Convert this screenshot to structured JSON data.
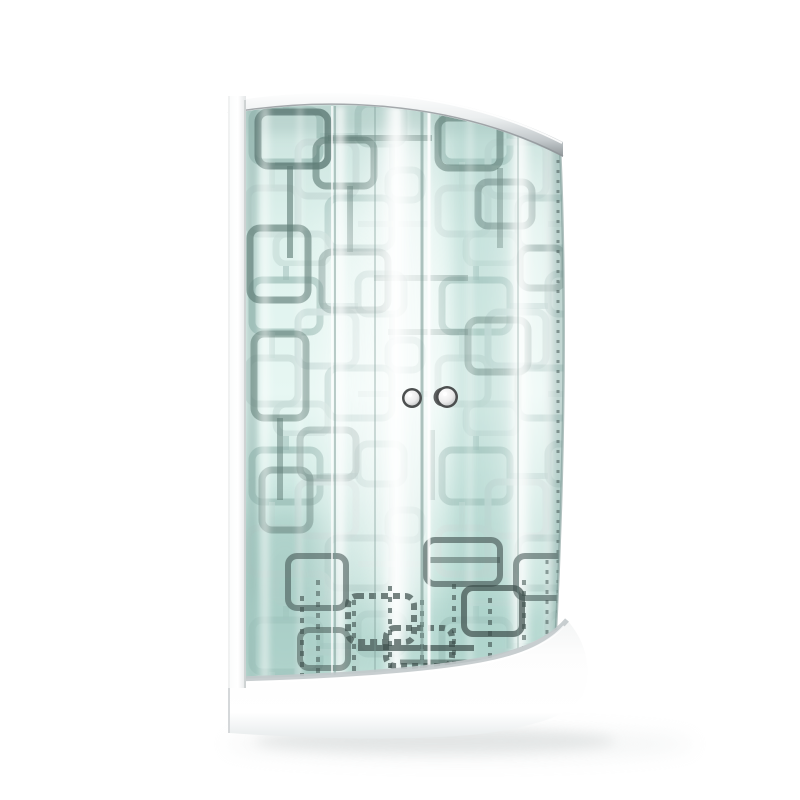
{
  "scene": {
    "description": "Product photograph of a quadrant corner shower enclosure with patterned frosted glass sliding doors, chrome top rail, two round chrome door knobs and a low white curved shower tray on a plain white background",
    "background": "#ffffff",
    "colors": {
      "glass_top": "#c7e0db",
      "glass_hi": "#ddf1ec",
      "glass_bright": "#e7f7f3",
      "glass_mid": "#c4e3dc",
      "glass_deep": "#b9dcd4",
      "glass_low": "#cde7e0",
      "pattern_light": "#c5dad6",
      "pattern_mid": "#8fb2ac",
      "pattern_dark": "#5e7b75",
      "pattern_darkest": "#3d4f4c",
      "seam_dark": "#7d9c96",
      "chrome_top": "#ffffff",
      "chrome_light": "#eceff0",
      "chrome_mid": "#c2c8cb",
      "chrome_dark": "#8e9598",
      "frame_light": "#fafbfb",
      "frame_mid": "#e4e7e8",
      "frame_edge": "#c6cbcc",
      "tray_light": "#fdfdfd",
      "tray_mid": "#f3f5f5",
      "tray_shade": "#e7ebec",
      "tray_rim": "#c2c9cb",
      "shadow": "#dcdfdf",
      "knob_ring": "#4c4f4f",
      "knob_face": "#ececec",
      "knob_face_edge": "#b5b8b9"
    },
    "pattern": {
      "tile": {
        "w": 190,
        "h": 170,
        "squares": [
          {
            "x": 12,
            "y": 14,
            "w": 68,
            "h": 52,
            "k": "mid",
            "o": 0.7
          },
          {
            "x": 58,
            "y": 46,
            "w": 58,
            "h": 54,
            "k": "light",
            "o": 0.9
          },
          {
            "x": 118,
            "y": 8,
            "w": 46,
            "h": 40,
            "k": "mid",
            "o": 0.5
          },
          {
            "x": 8,
            "y": 92,
            "w": 50,
            "h": 46,
            "k": "light",
            "o": 0.8
          },
          {
            "x": 88,
            "y": 102,
            "w": 64,
            "h": 50,
            "k": "mid",
            "o": 0.55
          },
          {
            "x": 36,
            "y": 138,
            "w": 52,
            "h": 30,
            "k": "light",
            "o": 0.7
          },
          {
            "x": 148,
            "y": 74,
            "w": 34,
            "h": 30,
            "k": "mid",
            "o": 0.45
          }
        ],
        "links": [
          {
            "x1": 46,
            "y1": 0,
            "x2": 46,
            "y2": 14,
            "k": "mid",
            "o": 0.5
          },
          {
            "x1": 80,
            "y1": 40,
            "x2": 118,
            "y2": 40,
            "k": "mid",
            "o": 0.45
          },
          {
            "x1": 32,
            "y1": 66,
            "x2": 32,
            "y2": 92,
            "k": "light",
            "o": 0.6
          },
          {
            "x1": 118,
            "y1": 128,
            "x2": 190,
            "y2": 128,
            "k": "light",
            "o": 0.5
          },
          {
            "x1": 152,
            "y1": 48,
            "x2": 152,
            "y2": 74,
            "k": "mid",
            "o": 0.4
          }
        ]
      }
    },
    "motifs_top": [
      {
        "x": 258,
        "y": 112,
        "w": 70,
        "h": 54,
        "o": 0.8
      },
      {
        "x": 316,
        "y": 140,
        "w": 58,
        "h": 46,
        "o": 0.6
      },
      {
        "x": 250,
        "y": 228,
        "w": 58,
        "h": 72,
        "o": 0.65
      },
      {
        "x": 322,
        "y": 252,
        "w": 66,
        "h": 58,
        "o": 0.45
      },
      {
        "x": 254,
        "y": 334,
        "w": 52,
        "h": 84,
        "o": 0.55
      },
      {
        "x": 438,
        "y": 118,
        "w": 62,
        "h": 50,
        "o": 0.6
      },
      {
        "x": 478,
        "y": 182,
        "w": 54,
        "h": 44,
        "o": 0.45
      },
      {
        "x": 520,
        "y": 248,
        "w": 44,
        "h": 40,
        "o": 0.4
      },
      {
        "x": 300,
        "y": 430,
        "w": 56,
        "h": 48,
        "o": 0.4
      },
      {
        "x": 468,
        "y": 320,
        "w": 60,
        "h": 52,
        "o": 0.42
      },
      {
        "x": 262,
        "y": 470,
        "w": 48,
        "h": 60,
        "o": 0.5
      }
    ],
    "links_top": [
      {
        "x1": 290,
        "y1": 166,
        "x2": 290,
        "y2": 258,
        "o": 0.6
      },
      {
        "x1": 328,
        "y1": 138,
        "x2": 432,
        "y2": 138,
        "o": 0.55
      },
      {
        "x1": 350,
        "y1": 186,
        "x2": 350,
        "y2": 252,
        "o": 0.5
      },
      {
        "x1": 374,
        "y1": 278,
        "x2": 468,
        "y2": 278,
        "o": 0.4
      },
      {
        "x1": 280,
        "y1": 418,
        "x2": 280,
        "y2": 500,
        "o": 0.5
      },
      {
        "x1": 500,
        "y1": 168,
        "x2": 500,
        "y2": 248,
        "o": 0.42
      },
      {
        "x1": 388,
        "y1": 332,
        "x2": 468,
        "y2": 332,
        "o": 0.38
      },
      {
        "x1": 432,
        "y1": 430,
        "x2": 432,
        "y2": 500,
        "o": 0.35
      }
    ],
    "motifs_bottom": [
      {
        "x": 288,
        "y": 556,
        "w": 58,
        "h": 52,
        "o": 0.55
      },
      {
        "x": 348,
        "y": 596,
        "w": 66,
        "h": 46,
        "o": 0.7,
        "dash": "7 5"
      },
      {
        "x": 426,
        "y": 540,
        "w": 74,
        "h": 44,
        "o": 0.6
      },
      {
        "x": 464,
        "y": 588,
        "w": 58,
        "h": 46,
        "o": 0.7
      },
      {
        "x": 516,
        "y": 556,
        "w": 50,
        "h": 42,
        "o": 0.55
      },
      {
        "x": 386,
        "y": 628,
        "w": 66,
        "h": 38,
        "o": 0.7,
        "dash": "6 5"
      },
      {
        "x": 300,
        "y": 630,
        "w": 48,
        "h": 38,
        "o": 0.5
      }
    ],
    "dark_strokes": [
      {
        "x1": 302,
        "y1": 596,
        "x2": 302,
        "y2": 676,
        "w": 4,
        "o": 0.6,
        "dash": "5 6"
      },
      {
        "x1": 318,
        "y1": 580,
        "x2": 318,
        "y2": 674,
        "w": 4,
        "o": 0.5,
        "dash": "5 6"
      },
      {
        "x1": 354,
        "y1": 600,
        "x2": 354,
        "y2": 676,
        "w": 4,
        "o": 0.6,
        "dash": "5 6"
      },
      {
        "x1": 390,
        "y1": 586,
        "x2": 390,
        "y2": 672,
        "w": 4,
        "o": 0.65,
        "dash": "5 6"
      },
      {
        "x1": 422,
        "y1": 600,
        "x2": 422,
        "y2": 676,
        "w": 4,
        "o": 0.55,
        "dash": "5 6"
      },
      {
        "x1": 454,
        "y1": 584,
        "x2": 454,
        "y2": 672,
        "w": 4,
        "o": 0.6,
        "dash": "5 6"
      },
      {
        "x1": 490,
        "y1": 598,
        "x2": 490,
        "y2": 670,
        "w": 4,
        "o": 0.6,
        "dash": "5 6"
      },
      {
        "x1": 524,
        "y1": 580,
        "x2": 524,
        "y2": 662,
        "w": 4,
        "o": 0.55,
        "dash": "5 6"
      },
      {
        "x1": 547,
        "y1": 560,
        "x2": 547,
        "y2": 640,
        "w": 3,
        "o": 0.5,
        "dash": "4 6"
      },
      {
        "x1": 358,
        "y1": 648,
        "x2": 474,
        "y2": 648,
        "w": 6,
        "o": 0.7
      },
      {
        "x1": 400,
        "y1": 662,
        "x2": 484,
        "y2": 662,
        "w": 5,
        "o": 0.55
      },
      {
        "x1": 430,
        "y1": 560,
        "x2": 500,
        "y2": 560,
        "w": 6,
        "o": 0.45
      }
    ],
    "streaks": [
      {
        "x": 265,
        "w": 14,
        "o": 0.6
      },
      {
        "x": 300,
        "w": 8,
        "o": 0.45
      },
      {
        "x": 340,
        "w": 16,
        "o": 0.85
      },
      {
        "x": 396,
        "w": 30,
        "o": 0.95
      },
      {
        "x": 428,
        "w": 6,
        "o": 0.5
      },
      {
        "x": 470,
        "w": 10,
        "o": 0.4
      },
      {
        "x": 520,
        "w": 26,
        "o": 0.9
      },
      {
        "x": 549,
        "w": 10,
        "o": 0.6
      }
    ],
    "glows": [
      {
        "cx": 400,
        "cy": 380,
        "rx": 45,
        "ry": 260,
        "o": 0.7
      },
      {
        "cx": 340,
        "cy": 420,
        "rx": 20,
        "ry": 220,
        "o": 0.5
      },
      {
        "cx": 527,
        "cy": 390,
        "rx": 22,
        "ry": 235,
        "o": 0.55
      }
    ],
    "seams": [
      {
        "x": 335,
        "w": 2,
        "k": "dark",
        "o": 0.5
      },
      {
        "x": 332,
        "w": 2,
        "k": "white",
        "o": 0.7
      },
      {
        "x": 375,
        "w": 2,
        "k": "dark",
        "o": 0.35
      },
      {
        "x": 422,
        "w": 3,
        "k": "dark",
        "o": 0.6
      },
      {
        "x": 429,
        "w": 3,
        "k": "white",
        "o": 0.85
      },
      {
        "x": 518,
        "w": 2,
        "k": "dark",
        "o": 0.3
      }
    ],
    "edge_dots": {
      "x": 558,
      "y1": 150,
      "y2": 618,
      "w": 3,
      "o": 0.5,
      "dash": "3 7"
    },
    "knobs": [
      {
        "cx": 412,
        "cy": 398,
        "r": 8.5,
        "crescent": false
      },
      {
        "cx": 447,
        "cy": 397,
        "r": 9.5,
        "crescent": true
      }
    ]
  }
}
